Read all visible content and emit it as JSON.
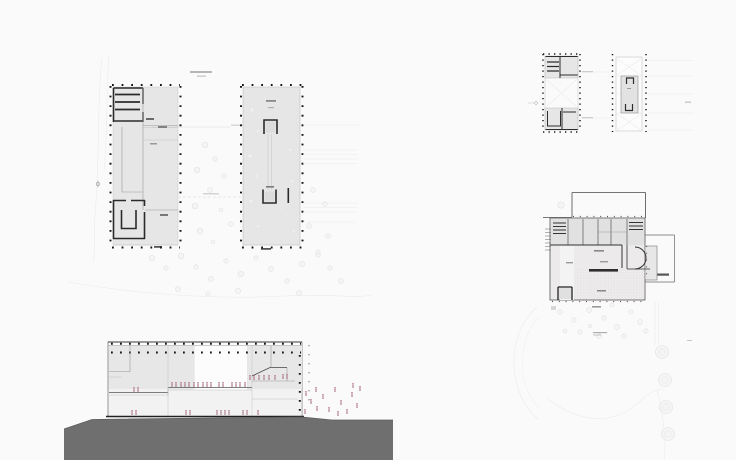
{
  "palette": {
    "background": "#fbfafa",
    "ink": "#3c3c3c",
    "wall": "#2b2b2b",
    "building_fill": "#e7e6e6",
    "ground": "#6f6f6f",
    "people": "#a4647f",
    "column_dot": "#161616",
    "faint_site_line": "#ececec"
  },
  "section_figures": {
    "mid_level": [
      [
        172,
        387
      ],
      [
        176,
        387
      ],
      [
        181,
        387
      ],
      [
        185,
        387
      ],
      [
        189,
        387
      ],
      [
        194,
        387
      ],
      [
        198,
        387
      ],
      [
        203,
        387
      ],
      [
        207,
        387
      ],
      [
        211,
        387
      ],
      [
        219,
        387
      ],
      [
        223,
        387
      ],
      [
        232,
        387
      ],
      [
        236,
        387
      ],
      [
        240,
        387
      ],
      [
        245,
        387
      ]
    ],
    "left_block": [
      [
        134,
        392
      ],
      [
        138,
        392
      ]
    ],
    "right_block": [
      [
        250,
        380
      ],
      [
        254,
        380
      ],
      [
        259,
        380
      ],
      [
        264,
        380
      ],
      [
        269,
        380
      ],
      [
        275,
        380
      ],
      [
        283,
        379
      ],
      [
        287,
        379
      ]
    ],
    "lower_level": [
      [
        132,
        415
      ],
      [
        136,
        415
      ],
      [
        186,
        415
      ],
      [
        190,
        415
      ],
      [
        217,
        415
      ],
      [
        221,
        415
      ],
      [
        225,
        415
      ],
      [
        229,
        415
      ],
      [
        243,
        415
      ],
      [
        247,
        415
      ],
      [
        258,
        415
      ]
    ],
    "outside_slope": [
      [
        306,
        396
      ],
      [
        311,
        404
      ],
      [
        317,
        411
      ],
      [
        323,
        399
      ],
      [
        329,
        412
      ],
      [
        335,
        392
      ],
      [
        341,
        405
      ],
      [
        347,
        414
      ],
      [
        352,
        397
      ],
      [
        357,
        408
      ],
      [
        305,
        414
      ],
      [
        316,
        392
      ],
      [
        360,
        391
      ],
      [
        353,
        388
      ],
      [
        338,
        416
      ]
    ]
  },
  "site_trees": {
    "courtyard": [
      [
        205,
        145,
        2.8
      ],
      [
        215,
        159,
        2.2
      ],
      [
        197,
        170,
        2.8
      ],
      [
        224,
        176,
        2.0
      ],
      [
        210,
        190,
        2.4
      ],
      [
        195,
        206,
        2.8
      ],
      [
        221,
        210,
        2.0
      ],
      [
        231,
        224,
        2.3
      ],
      [
        200,
        231,
        2.8
      ],
      [
        213,
        242,
        2.0
      ]
    ],
    "south_lawn": [
      [
        152,
        258,
        2.6
      ],
      [
        166,
        268,
        2.2
      ],
      [
        181,
        256,
        2.8
      ],
      [
        196,
        267,
        2.2
      ],
      [
        211,
        279,
        2.6
      ],
      [
        226,
        261,
        2.2
      ],
      [
        241,
        274,
        2.8
      ],
      [
        256,
        258,
        2.2
      ],
      [
        271,
        269,
        2.6
      ],
      [
        287,
        281,
        2.2
      ],
      [
        302,
        264,
        2.6
      ],
      [
        318,
        255,
        2.2
      ],
      [
        238,
        291,
        2.6
      ],
      [
        208,
        294,
        2.2
      ],
      [
        178,
        289,
        2.6
      ],
      [
        299,
        293,
        2.4
      ],
      [
        330,
        268,
        2.2
      ],
      [
        341,
        281,
        2.4
      ],
      [
        313,
        190,
        2.4
      ],
      [
        325,
        204,
        2.2
      ],
      [
        309,
        226,
        2.4
      ],
      [
        328,
        236,
        2.2
      ],
      [
        318,
        252,
        2.2
      ]
    ],
    "hall_interior": [
      [
        252,
        110,
        2.4
      ],
      [
        258,
        131,
        2.0
      ],
      [
        250,
        156,
        2.4
      ],
      [
        257,
        176,
        2.0
      ],
      [
        251,
        201,
        2.4
      ],
      [
        258,
        226,
        2.0
      ],
      [
        290,
        150,
        2.0
      ],
      [
        292,
        181,
        2.4
      ],
      [
        288,
        216,
        2.0
      ],
      [
        294,
        231,
        2.0
      ]
    ],
    "detail_garden": [
      [
        560,
        312,
        2.6
      ],
      [
        574,
        320,
        2.2
      ],
      [
        589,
        310,
        2.6
      ],
      [
        604,
        318,
        2.2
      ],
      [
        617,
        327,
        2.6
      ],
      [
        631,
        312,
        2.2
      ],
      [
        640,
        322,
        2.4
      ],
      [
        580,
        332,
        2.2
      ],
      [
        599,
        336,
        2.4
      ],
      [
        565,
        331,
        2.0
      ],
      [
        624,
        336,
        2.2
      ],
      [
        612,
        305,
        2.0
      ],
      [
        646,
        331,
        2.2
      ],
      [
        590,
        326,
        1.8
      ]
    ],
    "entry_tree": [
      [
        561,
        205,
        3.2
      ]
    ],
    "roadside": [
      [
        662,
        352,
        6.5
      ],
      [
        665,
        380,
        6.5
      ],
      [
        666,
        407,
        6.5
      ],
      [
        668,
        434,
        6.5
      ]
    ]
  }
}
